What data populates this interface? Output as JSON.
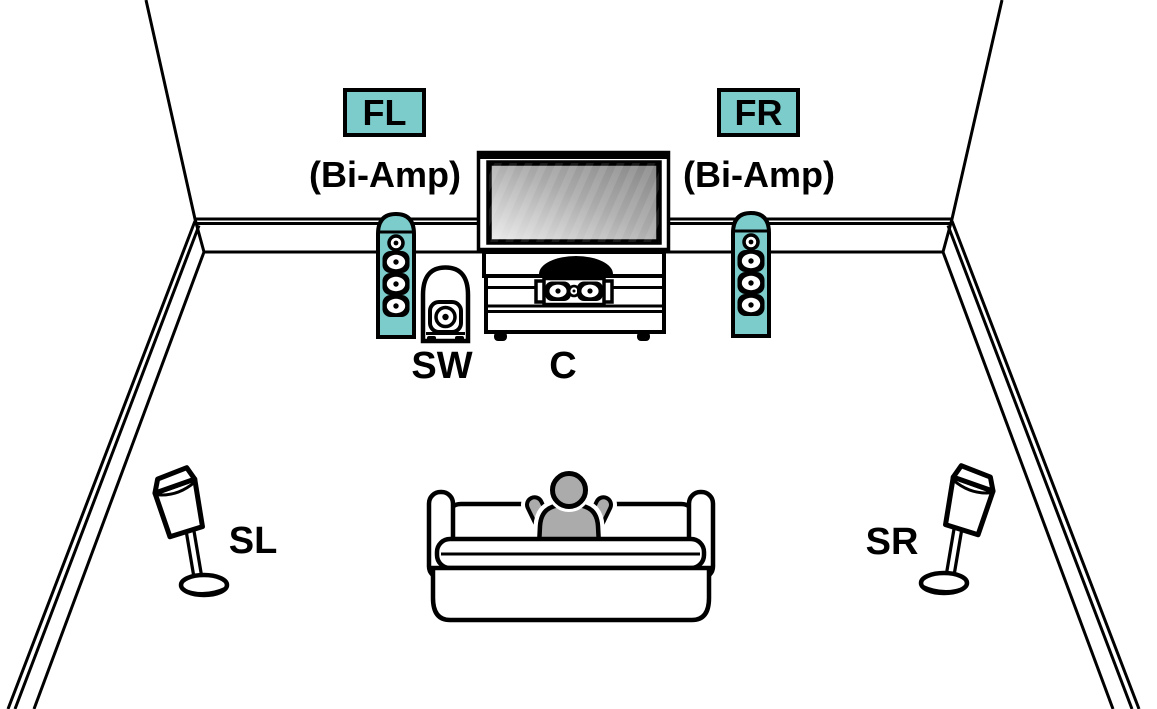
{
  "labels": {
    "front_left": "FL",
    "front_right": "FR",
    "bi_amp_left": "(Bi-Amp)",
    "bi_amp_right": "(Bi-Amp)",
    "subwoofer": "SW",
    "center": "C",
    "surround_left": "SL",
    "surround_right": "SR"
  },
  "colors": {
    "speaker_highlight": "#7CCCCC",
    "line": "#000000",
    "listener": "#ABABAB",
    "background": "#FFFFFF"
  }
}
